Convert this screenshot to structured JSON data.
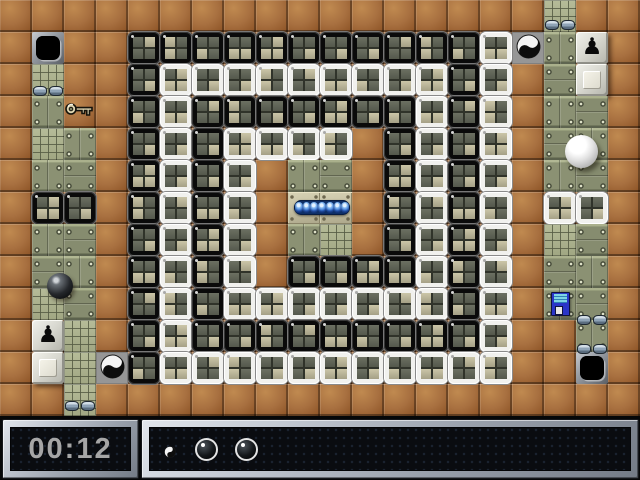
{
  "tile_size": 32,
  "hud": {
    "timer": "00:12",
    "inventory": {
      "items": [
        {
          "type": "yin-yang-item"
        },
        {
          "type": "black-marble-life"
        },
        {
          "type": "black-marble-life"
        }
      ]
    }
  },
  "grid": {
    "legend": {
      ".": "brick-floor",
      "B": "black-stone",
      "W": "white-stone",
      "M": "metal-floor",
      "G": "grid-floor",
      "L": "plate-floor",
      "h": "black-hole",
      "Y": "yin-yang-tile",
      "P": "pawn-button",
      "E": "blank-button"
    },
    "rows": [
      ".................G..",
      ".h..BBBBBBBBBBBWYMP.",
      ".G..BWWWWWWWWWBW.ME.",
      ".MK.BWBBBBBBBWBW.MM.",
      ".GM.BWBWWWW.BWBW.MM.",
      ".MM.BWBW.MM.BWBW.MM.",
      ".BB.BWBW.LL.BWBW.WW.",
      ".MM.BWBW.MG.BWBW.GM.",
      ".MM.BWBW.BBBBWBW.MM.",
      ".GM.BWBWWWWWWWBW.MM.",
      ".PG.BWBBBBBBBBBW..M.",
      ".EGYBWWWWWWWWWWW..h.",
      "..G................."
    ]
  },
  "items": [
    {
      "type": "key",
      "x": 64,
      "y": 99
    },
    {
      "type": "black-marble",
      "x": 47,
      "y": 273
    },
    {
      "type": "white-marble",
      "x": 565,
      "y": 135
    },
    {
      "type": "blue-pill",
      "x": 294,
      "y": 200
    },
    {
      "type": "floppy-disk",
      "x": 551,
      "y": 292
    },
    {
      "type": "pipe-caps",
      "x": 33,
      "y": 86
    },
    {
      "type": "pipe-caps",
      "x": 545,
      "y": 20
    },
    {
      "type": "pipe-caps",
      "x": 65,
      "y": 401
    },
    {
      "type": "pipe-caps",
      "x": 577,
      "y": 315
    },
    {
      "type": "pipe-caps",
      "x": 577,
      "y": 344
    }
  ],
  "glyphs": {
    "pawn": "♟"
  },
  "colors": {
    "brick": "#a87040",
    "metal": "#8b9173",
    "stone_black_frame": "#0a0a0a",
    "stone_white_frame": "#f1f1ee",
    "quad_light": "#bcb79a",
    "quad_dark": "#5f6356",
    "hud_frame": "#9aa1ac",
    "hud_bg": "#0a0c10",
    "timer_text": "#a6a6a6",
    "pill_blue": "#3a7ade"
  }
}
